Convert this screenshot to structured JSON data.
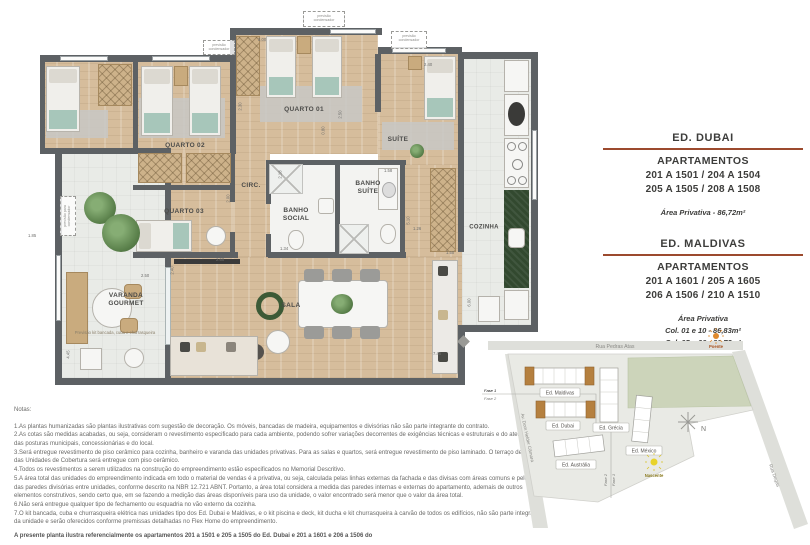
{
  "plan": {
    "rooms": {
      "quarto01": "QUARTO 01",
      "quarto02": "QUARTO 02",
      "quarto03": "QUARTO 03",
      "suite": "SUÍTE",
      "banho_suite": "BANHO\nSUÍTE",
      "banho_social": "BANHO\nSOCIAL",
      "circ": "CIRC.",
      "cozinha": "COZINHA",
      "sala": "SALA",
      "varanda": "VARANDA\nGOURMET"
    },
    "annotations": {
      "condenser": "previsão\ncondensador",
      "condenser_side": "previsão para\ncondensador",
      "kit_note": "Previsão kit bancada, cuba e churrasqueira"
    },
    "dims": {
      "d1": "3.00",
      "d2": "2.40",
      "d3": "2.50",
      "d4": "0.80",
      "d5": "2.30",
      "d6": "2.18",
      "d7": "1.58",
      "d8": "1.34",
      "d9": "5.10",
      "d10": "1.26",
      "d11": "1.50",
      "d12": "6.00",
      "d13": "2.00",
      "d14": "2.60",
      "d15": "2.40",
      "d16": "2.50",
      "d17": "1.85",
      "d18": "7.45",
      "d19": "4.45"
    }
  },
  "panel": {
    "dubai_title": "ED. DUBAI",
    "dubai_sub": "APARTAMENTOS",
    "dubai_line1": "201 A 1501 / 204 A 1504",
    "dubai_line2": "205 A 1505 / 208 A 1508",
    "dubai_area": "Área Privativa - 86,72m²",
    "maldivas_title": "ED. MALDIVAS",
    "maldivas_sub": "APARTAMENTOS",
    "maldivas_line1": "201 A 1601 / 205 A 1605",
    "maldivas_line2": "206 A 1506 / 210 A 1510",
    "maldivas_area_title": "Área Privativa",
    "maldivas_area1": "Col. 01 e 10 - 86,83m²",
    "maldivas_area2": "Col. 05 e 06 - 86,72m²"
  },
  "notes": {
    "title": "Notas:",
    "items": [
      "1.As plantas humanizadas são plantas ilustrativas com sugestão de decoração. Os móveis, bancadas de madeira, equipamentos e divisórias não são parte integrante do contrato.",
      "2.As cotas são medidas acabadas, ou seja, consideram o revestimento especificado para cada ambiente, podendo sofrer variações decorrentes de exigências técnicas e estruturais e do atendimento das posturas municipais, concessionárias e do local.",
      "3.Será entregue revestimento de piso cerâmico para cozinha, banheiro e varanda das unidades privativas. Para as salas e quartos, será entregue revestimento de piso laminado. O terraço descoberto das Unidades de Cobertura será entregue com piso cerâmico.",
      "4.Todos os revestimentos a serem utilizados na construção do empreendimento estão especificados no Memorial Descritivo.",
      "5.A área total das unidades do empreendimento indicada em todo o material de vendas é a privativa, ou seja, calculada pelas linhas externas da fachada e das divisas com áreas comuns e pelo eixo das paredes divisórias entre unidades, conforme descrito na NBR 12.721 ABNT. Portanto, a área total considera a medida das paredes internas e externas do apartamento, ademais de outros elementos construtivos, sendo certo que, em se fazendo a medição das áreas disponíveis para uso da unidade, o valor encontrado será menor que o valor da área total.",
      "6.Não será entregue qualquer tipo de fechamento ou esquadria no vão externo da cozinha.",
      "7.O kit bancada, cuba e churrasqueira elétrica nas unidades tipo dos Ed. Dubai e Maldivas, e o kit piscina e deck, kit ducha e kit churrasqueira à carvão de todos os edifícios, não são parte integrante da unidade e serão oferecidos conforme premissas detalhadas no Flex Home do empreendimento."
    ],
    "footer": "A presente planta ilustra referencialmente os apartamentos 201 a 1501 e 205 a 1505 do Ed. Dubai e 201 a 1601 e 206 a 1506 do"
  },
  "map": {
    "street_top": "Rua Pedras Atas",
    "street_left": "Av. Dom Helder Câmara",
    "street_right": "Rua Degas",
    "b_maldivas": "Ed. Maldivas",
    "b_dubai": "Ed. Dubai",
    "b_grecia": "Ed. Grécia",
    "b_mexico": "Ed. México",
    "b_australia": "Ed. Austrália",
    "sun_west": "Poente",
    "sun_east": "Nascente",
    "compass_n": "N",
    "fase1": "Fase 1",
    "fase2": "Fase 2"
  },
  "colors": {
    "accent_rule": "#9c4a2e",
    "wall": "#5d6164",
    "wood_floor": "#d6bd9c",
    "teal_fabric": "#a7c6ba",
    "counter_green": "#32492f",
    "sun_west": "#e08a2e",
    "sun_east": "#e8d32b",
    "phase_building": "#b5803f"
  }
}
